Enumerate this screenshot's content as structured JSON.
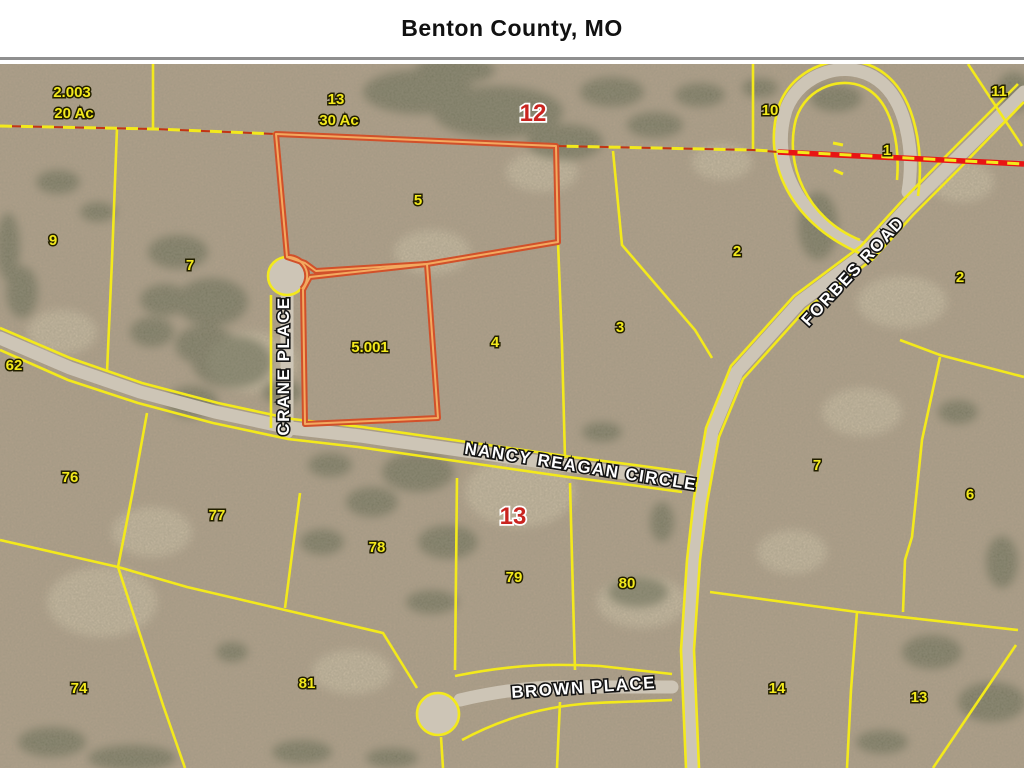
{
  "title": "Benton County, MO",
  "map": {
    "colors": {
      "parcel_line_yellow": "#f3e91c",
      "highlight_orange_outer": "#d1502a",
      "highlight_orange_inner": "#f3aa60",
      "section_red": "#e81414",
      "red_label": "#c92420",
      "road_gray": "#cdc5b6",
      "terrain_base": "#b2a18b"
    },
    "road_labels": [
      {
        "text": "CRANE PLACE",
        "x": 289,
        "y": 366,
        "rotate": -90,
        "size": 16
      },
      {
        "text": "NANCY REAGAN CIRCLE",
        "x": 580,
        "y": 472,
        "rotate": 9,
        "size": 17
      },
      {
        "text": "FORBES ROAD",
        "x": 857,
        "y": 275,
        "rotate": -47,
        "size": 17
      },
      {
        "text": "BROWN PLACE",
        "x": 584,
        "y": 693,
        "rotate": -4,
        "size": 17
      }
    ],
    "parcel_labels": [
      {
        "text": "2.003",
        "x": 72,
        "y": 97
      },
      {
        "text": "20 Ac",
        "x": 74,
        "y": 118
      },
      {
        "text": "13",
        "x": 336,
        "y": 104
      },
      {
        "text": "30 Ac",
        "x": 339,
        "y": 125
      },
      {
        "text": "9",
        "x": 53,
        "y": 245
      },
      {
        "text": "7",
        "x": 190,
        "y": 270
      },
      {
        "text": "5",
        "x": 418,
        "y": 205
      },
      {
        "text": "10",
        "x": 770,
        "y": 115
      },
      {
        "text": "11",
        "x": 999,
        "y": 96
      },
      {
        "text": "1",
        "x": 887,
        "y": 155
      },
      {
        "text": "2",
        "x": 737,
        "y": 256
      },
      {
        "text": "2",
        "x": 960,
        "y": 282
      },
      {
        "text": "3",
        "x": 620,
        "y": 332
      },
      {
        "text": "4",
        "x": 495,
        "y": 347
      },
      {
        "text": "5.001",
        "x": 370,
        "y": 352
      },
      {
        "text": "62",
        "x": 14,
        "y": 370
      },
      {
        "text": "76",
        "x": 70,
        "y": 482
      },
      {
        "text": "77",
        "x": 217,
        "y": 520
      },
      {
        "text": "78",
        "x": 377,
        "y": 552
      },
      {
        "text": "79",
        "x": 514,
        "y": 582
      },
      {
        "text": "80",
        "x": 627,
        "y": 588
      },
      {
        "text": "7",
        "x": 817,
        "y": 470
      },
      {
        "text": "6",
        "x": 970,
        "y": 499
      },
      {
        "text": "74",
        "x": 79,
        "y": 693
      },
      {
        "text": "81",
        "x": 307,
        "y": 688
      },
      {
        "text": "14",
        "x": 777,
        "y": 693
      },
      {
        "text": "13",
        "x": 919,
        "y": 702
      }
    ],
    "section_number_labels": [
      {
        "text": "12",
        "x": 533,
        "y": 121
      },
      {
        "text": "13",
        "x": 513,
        "y": 524
      }
    ]
  }
}
